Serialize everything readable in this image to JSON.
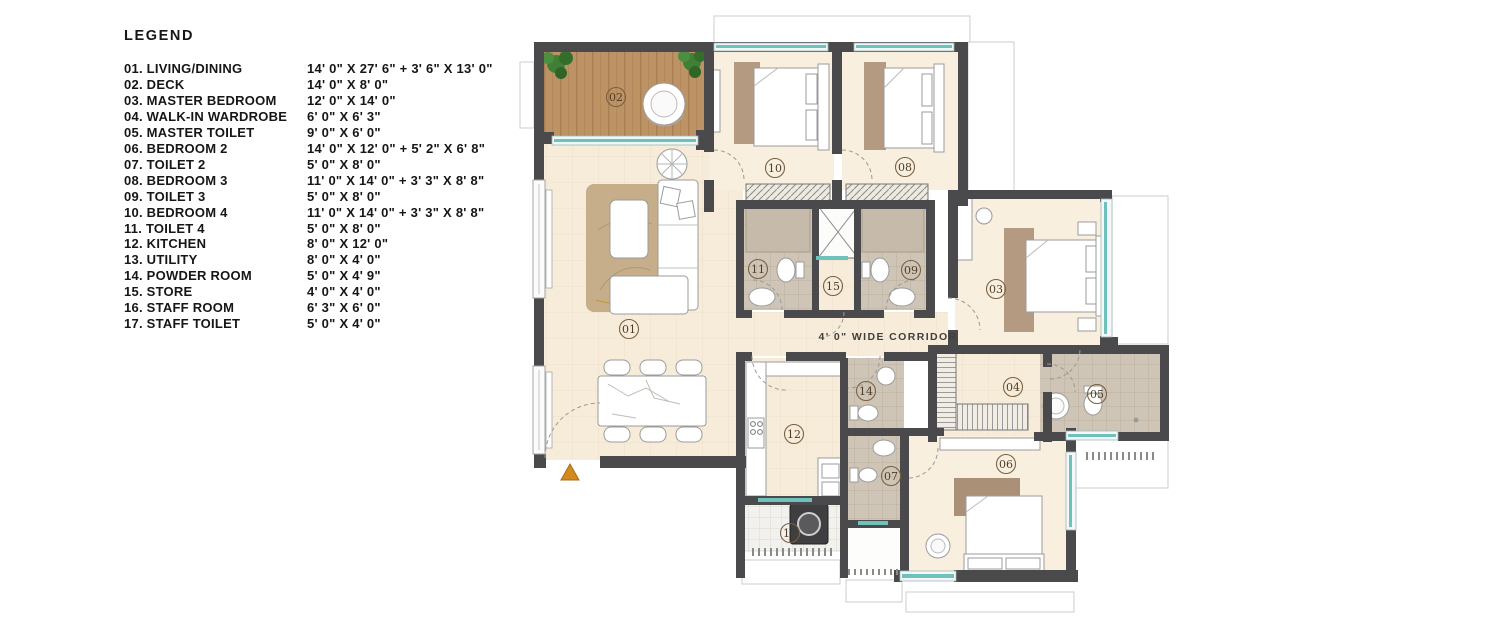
{
  "legend": {
    "title": "LEGEND",
    "items": [
      {
        "label": "01. LIVING/DINING",
        "dims": "14' 0\" X 27' 6\" + 3' 6\" X 13' 0\""
      },
      {
        "label": "02. DECK",
        "dims": "14' 0\" X 8' 0\""
      },
      {
        "label": "03. MASTER BEDROOM",
        "dims": "12' 0\" X 14' 0\""
      },
      {
        "label": "04. WALK-IN WARDROBE",
        "dims": "6' 0\" X 6' 3\""
      },
      {
        "label": "05. MASTER TOILET",
        "dims": "9' 0\" X 6' 0\""
      },
      {
        "label": "06. BEDROOM 2",
        "dims": "14' 0\" X 12' 0\" + 5' 2\" X 6' 8\""
      },
      {
        "label": "07. TOILET 2",
        "dims": "5' 0\" X 8' 0\""
      },
      {
        "label": "08. BEDROOM 3",
        "dims": "11' 0\" X 14' 0\" + 3' 3\" X 8' 8\""
      },
      {
        "label": "09. TOILET 3",
        "dims": "5' 0\" X 8' 0\""
      },
      {
        "label": "10. BEDROOM 4",
        "dims": "11' 0\" X 14' 0\" + 3' 3\" X 8' 8\""
      },
      {
        "label": "11. TOILET 4",
        "dims": "5' 0\" X 8' 0\""
      },
      {
        "label": "12. KITCHEN",
        "dims": "8' 0\" X 12' 0\""
      },
      {
        "label": "13. UTILITY",
        "dims": "8' 0\" X 4' 0\""
      },
      {
        "label": "14. POWDER ROOM",
        "dims": "5' 0\" X 4' 9\""
      },
      {
        "label": "15. STORE",
        "dims": "4' 0\" X 4' 0\""
      },
      {
        "label": "16. STAFF ROOM",
        "dims": "6' 3\" X 6' 0\""
      },
      {
        "label": "17. STAFF TOILET",
        "dims": "5' 0\" X 4' 0\""
      }
    ]
  },
  "plan": {
    "corridor_label": "4' 0\" WIDE CORRIDOR",
    "room_labels": {
      "r01": "01",
      "r02": "02",
      "r03": "03",
      "r04": "04",
      "r05": "05",
      "r06": "06",
      "r07": "07",
      "r08": "08",
      "r09": "09",
      "r10": "10",
      "r11": "11",
      "r12": "12",
      "r13": "13",
      "r14": "14",
      "r15": "15"
    }
  },
  "colors": {
    "wall": "#4a4a4c",
    "floor": "#f6ecd9",
    "floor_bedroom": "#f8efdf",
    "deck_wood": "#bd9265",
    "window_glass": "#6fc2bc",
    "tile": "#cfc5b6",
    "utility_tile": "#f2f1ee",
    "entry_marker": "#d28a1e",
    "plant": "#417f36",
    "label_ink": "#4f3d28"
  }
}
